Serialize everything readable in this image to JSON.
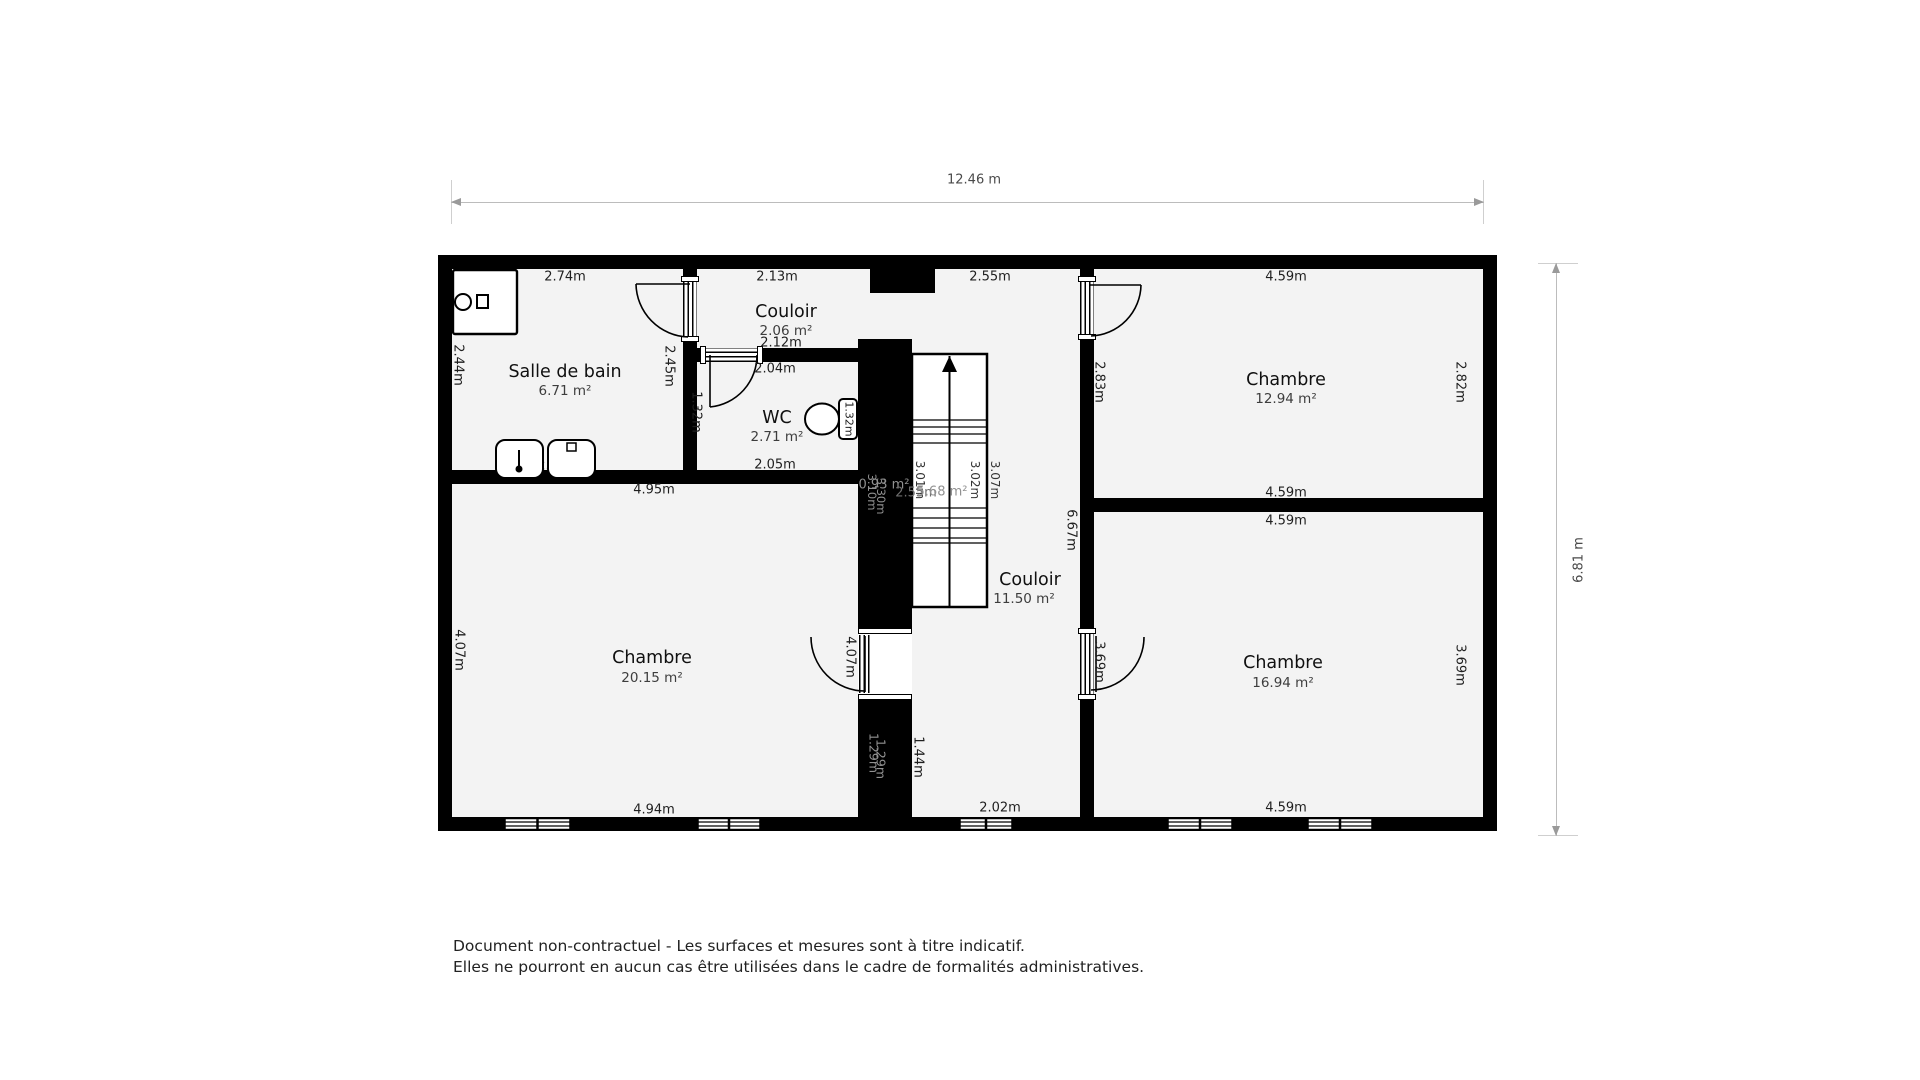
{
  "page": {
    "bg": "#ffffff",
    "wall_color": "#000000",
    "room_fill": "#f3f3f3",
    "dim_line_color": "#bcbcbc"
  },
  "plan": {
    "dim_top": "12.46 m",
    "dim_right": "6.81 m",
    "rooms": {
      "bath": {
        "name": "Salle de bain",
        "area": "6.71 m²",
        "top": "2.74m",
        "left": "2.44m",
        "right": "2.45m",
        "bottom": "2.74m"
      },
      "hall1": {
        "name": "Couloir",
        "area": "2.06 m²",
        "top": "2.13m",
        "bottom": "2.12m"
      },
      "wc": {
        "name": "WC",
        "area": "2.71 m²",
        "top": "2.04m",
        "left": "1.32m",
        "right": "1.32m",
        "bottom": "2.05m"
      },
      "landing": {
        "top": "2.55m"
      },
      "bed1": {
        "name": "Chambre",
        "area": "12.94 m²",
        "top": "4.59m",
        "left": "2.83m",
        "right": "2.82m",
        "bottom": "4.59m"
      },
      "bed2": {
        "name": "Chambre",
        "area": "20.15 m²",
        "top": "4.95m",
        "left": "4.07m",
        "door": "4.07m",
        "bottom": "4.94m"
      },
      "bed3": {
        "name": "Chambre",
        "area": "16.94 m²",
        "top": "4.59m",
        "door": "3.69m",
        "right": "3.69m",
        "bottom": "4.59m"
      },
      "hall2": {
        "name": "Couloir",
        "area": "11.50 m²",
        "right": "6.67m",
        "wall": "1.44m",
        "bottom": "2.02m"
      },
      "stairs": {
        "left": "3.01m",
        "mid": "3.02m",
        "right": "3.07m",
        "area_under": "0.93 m²",
        "area_stair": "5.68 m²",
        "dim_a": "2.55m",
        "dim_b": "3.10m",
        "dim_c": "3.30m",
        "dim_d": "1.29m",
        "dim_e": "1.29m"
      }
    }
  },
  "footer": {
    "line1": "Document non-contractuel - Les surfaces et mesures sont à titre indicatif.",
    "line2": "Elles ne pourront en aucun cas être utilisées dans le cadre de formalités administratives."
  }
}
